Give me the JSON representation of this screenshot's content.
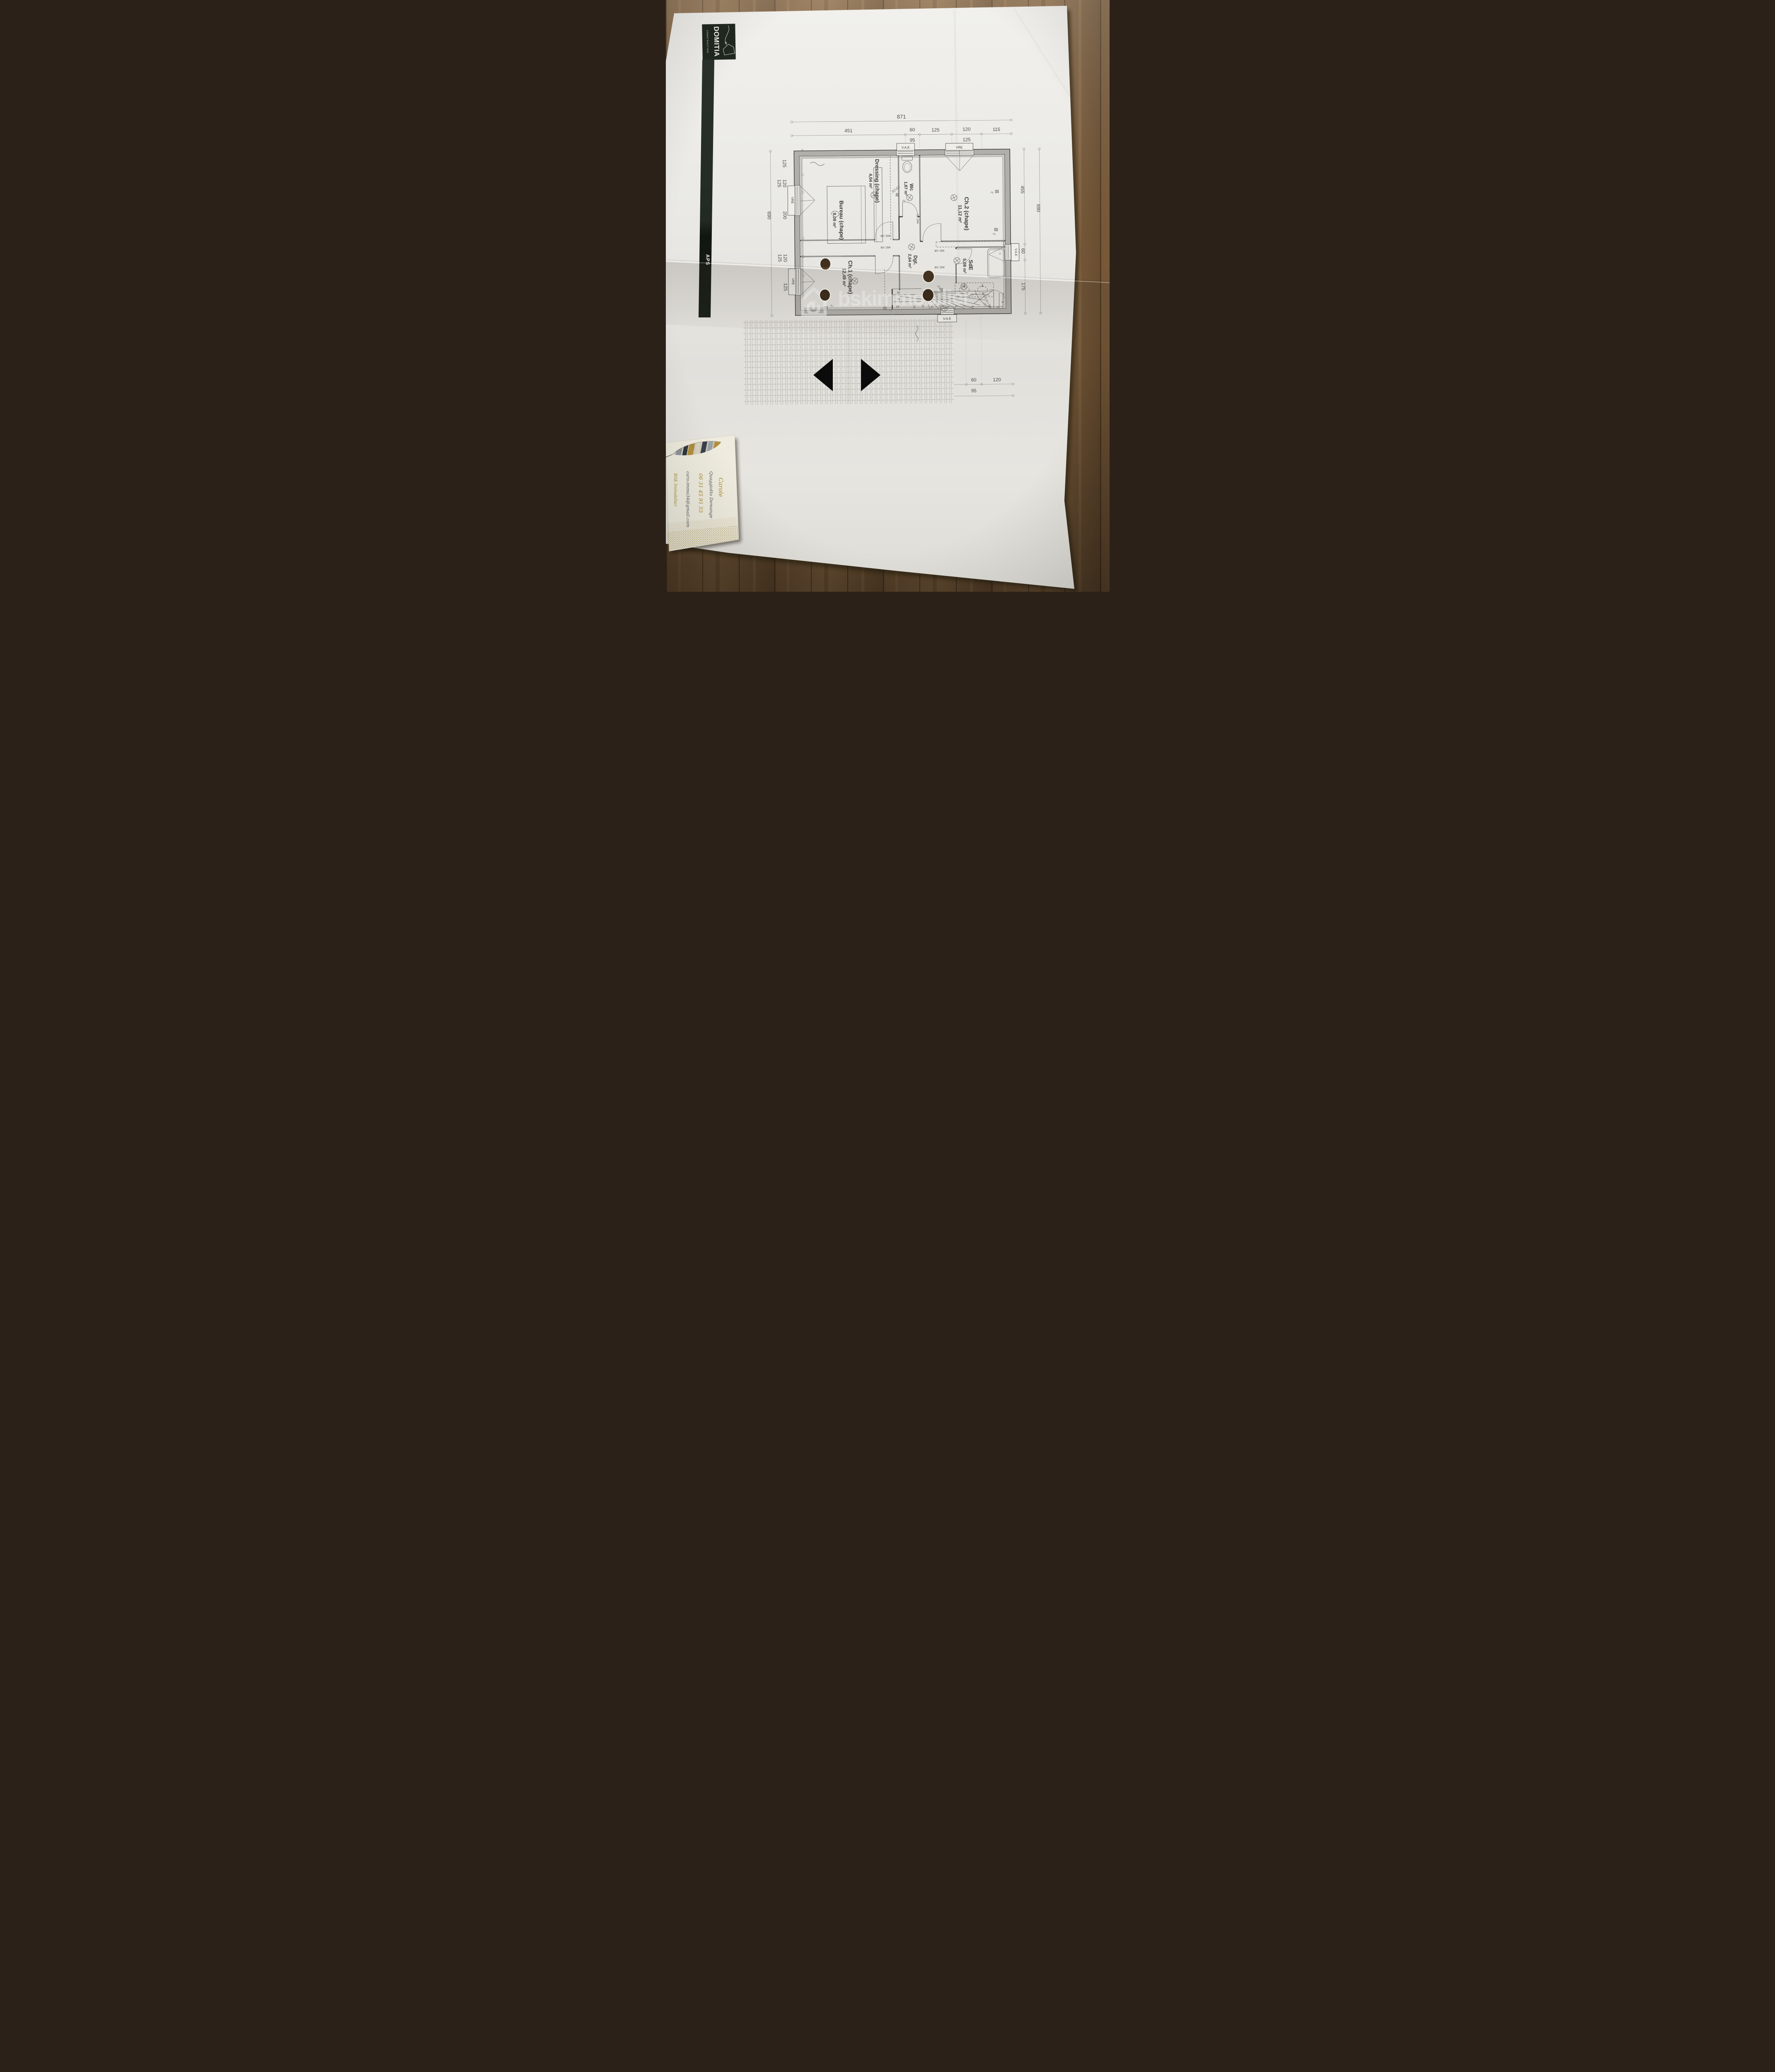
{
  "branding": {
    "logo_title": "DOMITIA",
    "logo_subtitle": "CONSTRUCTION",
    "side_strip_label": "APS"
  },
  "watermark": {
    "text": "bskimmobilier"
  },
  "plan": {
    "labels": {
      "vae": "V.A.E",
      "vre": "VRE",
      "door73": "73 / 204",
      "door83": "83 / 204"
    },
    "rooms": [
      {
        "name": "Bureau (chape)",
        "area": "8,09 m²"
      },
      {
        "name": "Dressing (chape)",
        "area": "4,04 m²"
      },
      {
        "name": "Wc",
        "area": "1,87 m²"
      },
      {
        "name": "Ch.2 (chape)",
        "area": "11,12 m²"
      },
      {
        "name": "Dgt.",
        "area": "2,64 m²"
      },
      {
        "name": "SdE",
        "area": "5,08 m²"
      },
      {
        "name": "Ch.1 (chape)",
        "area": "12,49 m²"
      }
    ],
    "stairs": {
      "treads": [
        "16",
        "15",
        "14",
        "13",
        "12",
        "11",
        "10",
        "9",
        "8",
        "7",
        "6",
        "5",
        "4",
        "3",
        "2"
      ],
      "formula": "16 x 17,5 = 283"
    },
    "annotations": {
      "r545": "R545",
      "pc": "pc",
      "h35": "35"
    }
  },
  "dims": {
    "top_total": "871",
    "top": [
      {
        "main": "451"
      },
      {
        "main": "60",
        "sub": "95"
      },
      {
        "main": "125"
      },
      {
        "main": "120",
        "sub": "125"
      },
      {
        "main": "115"
      }
    ],
    "left_outer": "690",
    "left": [
      {
        "main": "125"
      },
      {
        "main": "120",
        "sub": "125"
      },
      {
        "main": "200"
      },
      {
        "main": "120",
        "sub": "125"
      },
      {
        "main": "125"
      }
    ],
    "right": [
      {
        "main": "455"
      },
      {
        "main": "690"
      },
      {
        "main": "60",
        "sub": "95"
      },
      {
        "main": "175"
      }
    ],
    "bottom": [
      {
        "main": "691"
      },
      {
        "main": "60",
        "sub": "95"
      },
      {
        "main": "120"
      }
    ],
    "bottom_total": "871"
  },
  "card": {
    "first_name": "Carole",
    "last_name": "Quaggiotto Demange",
    "phone": "06 31 45 91 55",
    "email": "caro.immo34@gmail.com",
    "company": "BSK Immobilier"
  }
}
